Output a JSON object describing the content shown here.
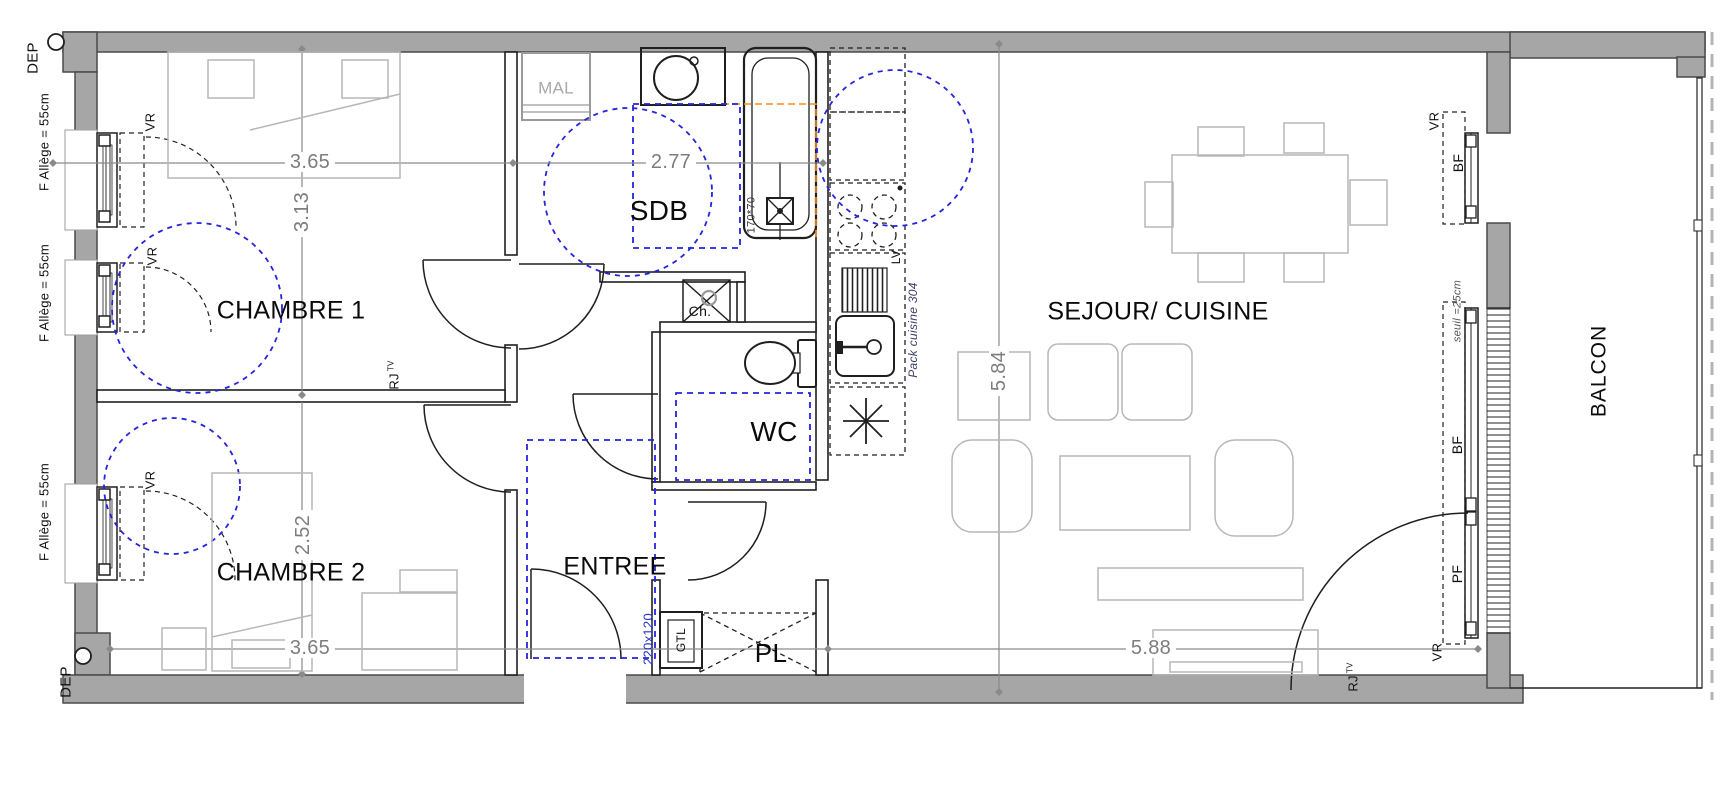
{
  "plan": {
    "rooms": [
      {
        "id": "chambre1",
        "label": "CHAMBRE 1"
      },
      {
        "id": "chambre2",
        "label": "CHAMBRE 2"
      },
      {
        "id": "sdb",
        "label": "SDB"
      },
      {
        "id": "wc",
        "label": "WC"
      },
      {
        "id": "entree",
        "label": "ENTREE"
      },
      {
        "id": "pl",
        "label": "PL"
      },
      {
        "id": "sejour_cuisine",
        "label": "SEJOUR/ CUISINE"
      },
      {
        "id": "balcon",
        "label": "BALCON"
      }
    ],
    "dimensions_m": [
      {
        "room": "chambre1",
        "axis": "width",
        "value": "3.65"
      },
      {
        "room": "chambre1",
        "axis": "depth",
        "value": "3.13"
      },
      {
        "room": "sdb",
        "axis": "width",
        "value": "2.77"
      },
      {
        "room": "chambre2",
        "axis": "depth",
        "value": "2.52"
      },
      {
        "room": "chambre2",
        "axis": "width",
        "value": "3.65"
      },
      {
        "room": "sejour_cuisine",
        "axis": "depth",
        "value": "5.84"
      },
      {
        "room": "sejour_cuisine",
        "axis": "width",
        "value": "5.88"
      }
    ],
    "annotations": {
      "dep": "DEP",
      "window_sill": "F  Allège = 55cm",
      "roller_shutter": "VR",
      "low_window": "BF",
      "french_window": "PF",
      "threshold": "seuil =25cm",
      "network_socket": "RJ",
      "network_socket_sub": "TV",
      "washing_machine": "MAL",
      "bathtub_size": "170*70",
      "dishwasher": "LV",
      "kitchen_pack": "Pack cuisine 304",
      "water_heater": "Ch.",
      "gtl": "GTL",
      "entry_door_size": "220x120"
    },
    "colors": {
      "wall_fill": "#a6a6a6",
      "line": "#1f1f1f",
      "furniture_line": "#b7b7b7",
      "dimension_line": "#8a8a8a",
      "accessibility_blue": "#2424dd",
      "marker_orange": "#ff8c1a",
      "door_size_blue": "#2233cc"
    }
  }
}
